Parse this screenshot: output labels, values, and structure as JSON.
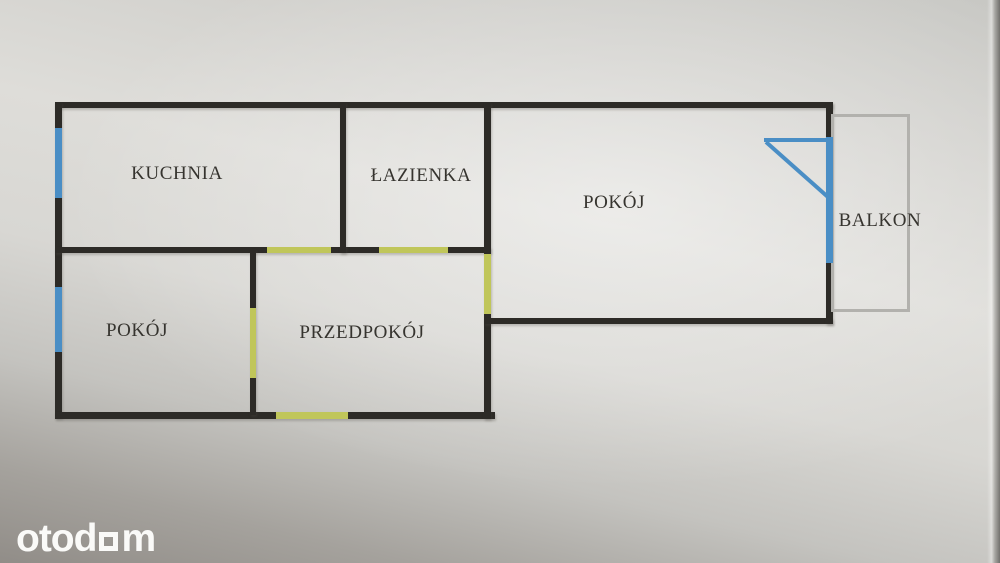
{
  "floorplan": {
    "rooms": [
      {
        "key": "kuchnia",
        "label": "KUCHNIA"
      },
      {
        "key": "lazienka",
        "label": "ŁAZIENKA"
      },
      {
        "key": "pokoj_main",
        "label": "POKÓJ"
      },
      {
        "key": "pokoj_small",
        "label": "POKÓJ"
      },
      {
        "key": "przedpokoj",
        "label": "PRZEDPOKÓJ"
      },
      {
        "key": "balkon",
        "label": "BALKON"
      }
    ],
    "colors": {
      "wall": "#2d2b27",
      "window": "#4a8ec5",
      "door": "#c0c65a",
      "balcony_outline": "#b2b1ad",
      "label_text": "#36342f",
      "watermark": "#fafaf8"
    }
  },
  "watermark": {
    "brand": "otodom",
    "prefix": "otod",
    "suffix": "m"
  }
}
